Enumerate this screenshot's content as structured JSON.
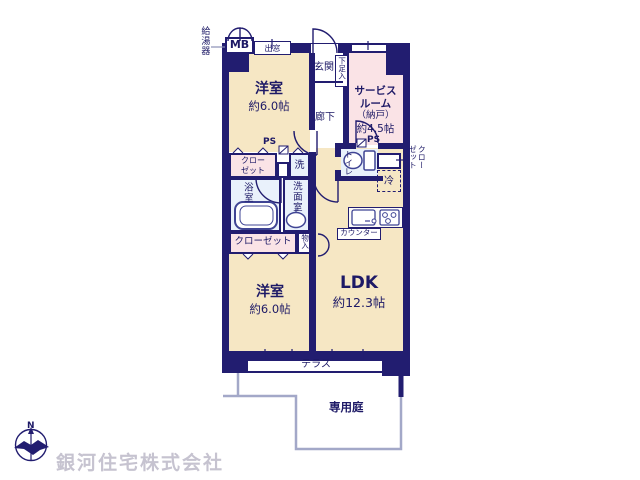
{
  "colors": {
    "wall_navy": "#221d70",
    "room_cream": "#f6e7c4",
    "room_pink": "#fae3e6",
    "wet_blue": "#e9f1fb",
    "outline_gray": "#a3a8c8",
    "watermark_gray": "#c6c3d0"
  },
  "plan": {
    "water_heater": "給湯器",
    "meter_box": "MB",
    "bay_window": "出窓",
    "entrance": "玄関",
    "shoe_cabinet": "下足入",
    "corridor": "廊下",
    "western_room_top": {
      "name": "洋室",
      "size": "約6.0帖"
    },
    "service_room": {
      "line1": "サービス",
      "line2": "ルーム",
      "line3": "（納戸）",
      "line4": "約4.5帖"
    },
    "ps_left": "PS",
    "ps_right": "PS",
    "closet_upper": {
      "line1": "クロー",
      "line2": "ゼット"
    },
    "washer": "洗",
    "bathroom": "浴室",
    "washroom": "洗面室",
    "toilet": "トイレ",
    "refrigerator": "冷",
    "closet_right": {
      "col1": "クロー",
      "col2": "ゼット"
    },
    "closet_lower": "クローゼット",
    "storage": "物入",
    "western_room_bottom": {
      "name": "洋室",
      "size": "約6.0帖"
    },
    "ldk": {
      "name": "LDK",
      "size": "約12.3帖"
    },
    "counter": "カウンター",
    "terrace": "テラス",
    "private_garden": "専用庭"
  },
  "footer": {
    "company": "銀河住宅株式会社",
    "compass_north": "N"
  }
}
